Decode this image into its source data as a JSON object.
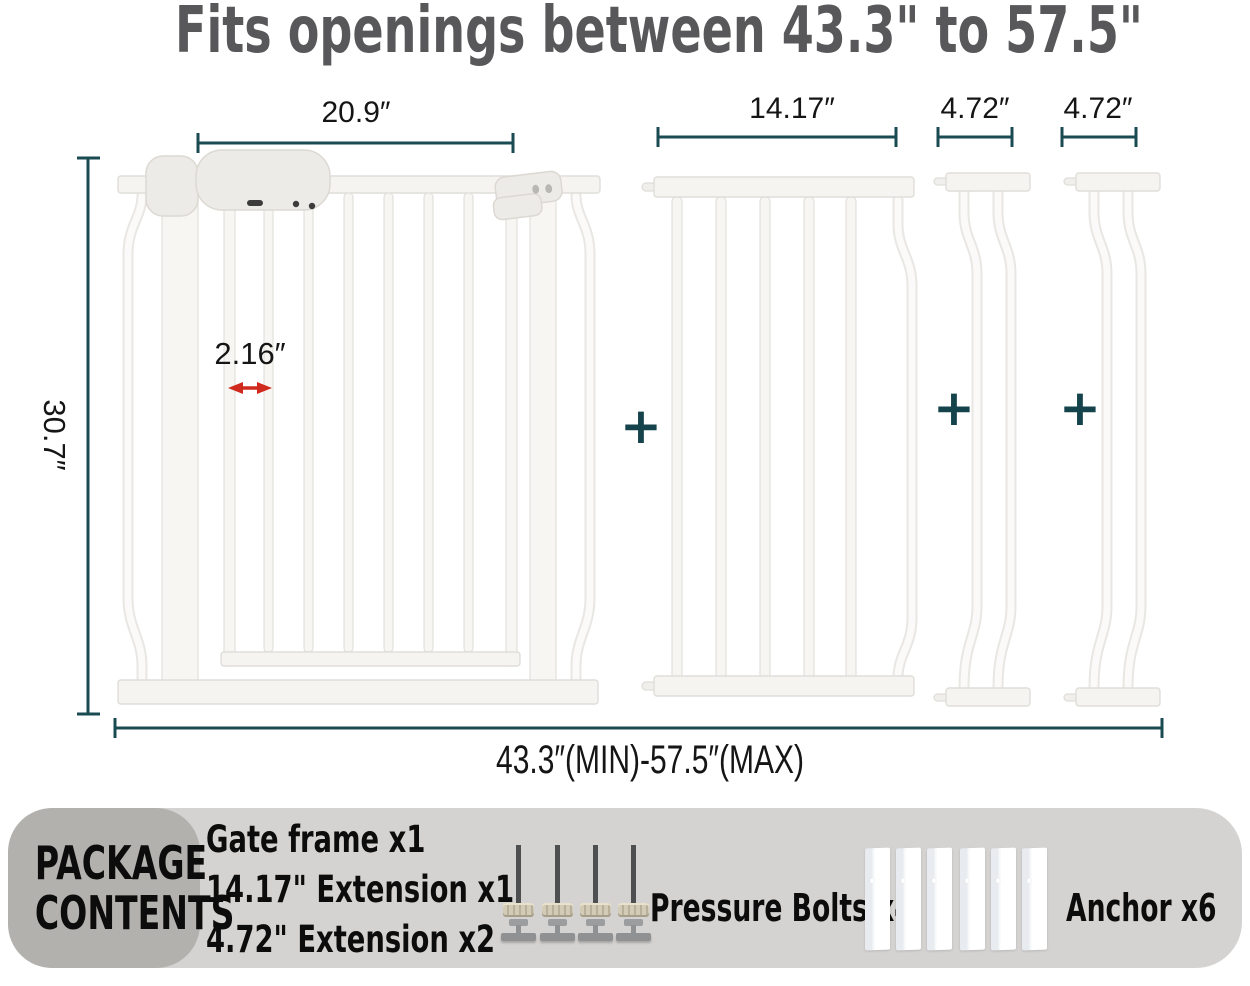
{
  "title": "Fits openings between 43.3\" to 57.5\"",
  "diagram": {
    "labels": {
      "gate_width": "20.9″",
      "ext_large_width": "14.17″",
      "ext_small_width_1": "4.72″",
      "ext_small_width_2": "4.72″",
      "height": "30.7″",
      "bar_gap": "2.16″",
      "total_range": "43.3″(MIN)-57.5″(MAX)"
    },
    "plus": "+"
  },
  "package": {
    "heading_line1": "PACKAGE",
    "heading_line2": "CONTENTS",
    "items": [
      "Gate frame x1",
      "14.17\" Extension x1",
      "4.72\" Extension x2"
    ],
    "bolts_label": "Pressure Bolts x4",
    "anchor_label": "Anchor x6"
  },
  "colors": {
    "title_text": "#58585a",
    "dimension_line": "#1b4b52",
    "gap_arrow_red": "#d02a1e",
    "band_background": "#d5d3d1",
    "package_box_background": "#b3b1ae",
    "gate_metal": "#f5f4f1"
  }
}
